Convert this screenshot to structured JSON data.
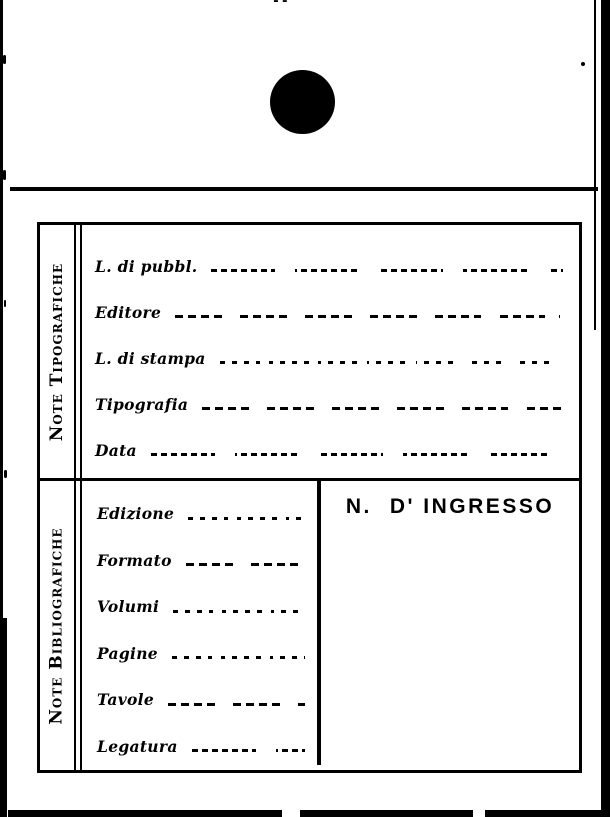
{
  "colors": {
    "ink": "#000000",
    "paper": "#ffffff"
  },
  "marks": {
    "stamp": "filled-circle-ink-stamp",
    "top_dashes": "--"
  },
  "form": {
    "sections": [
      {
        "id": "note-tipografiche",
        "side_label": "Note Tipografiche",
        "fields": [
          {
            "label": "L. di pubbl.",
            "value": ""
          },
          {
            "label": "Editore",
            "value": ""
          },
          {
            "label": "L. di stampa",
            "value": ""
          },
          {
            "label": "Tipografia",
            "value": ""
          },
          {
            "label": "Data",
            "value": ""
          }
        ]
      },
      {
        "id": "note-bibliografiche",
        "side_label": "Note Bibliografiche",
        "fields": [
          {
            "label": "Edizione",
            "value": ""
          },
          {
            "label": "Formato",
            "value": ""
          },
          {
            "label": "Volumi",
            "value": ""
          },
          {
            "label": "Pagine",
            "value": ""
          },
          {
            "label": "Tavole",
            "value": ""
          },
          {
            "label": "Legatura",
            "value": ""
          }
        ],
        "ingresso": {
          "prefix": "N.",
          "label": "D' INGRESSO"
        }
      }
    ]
  }
}
